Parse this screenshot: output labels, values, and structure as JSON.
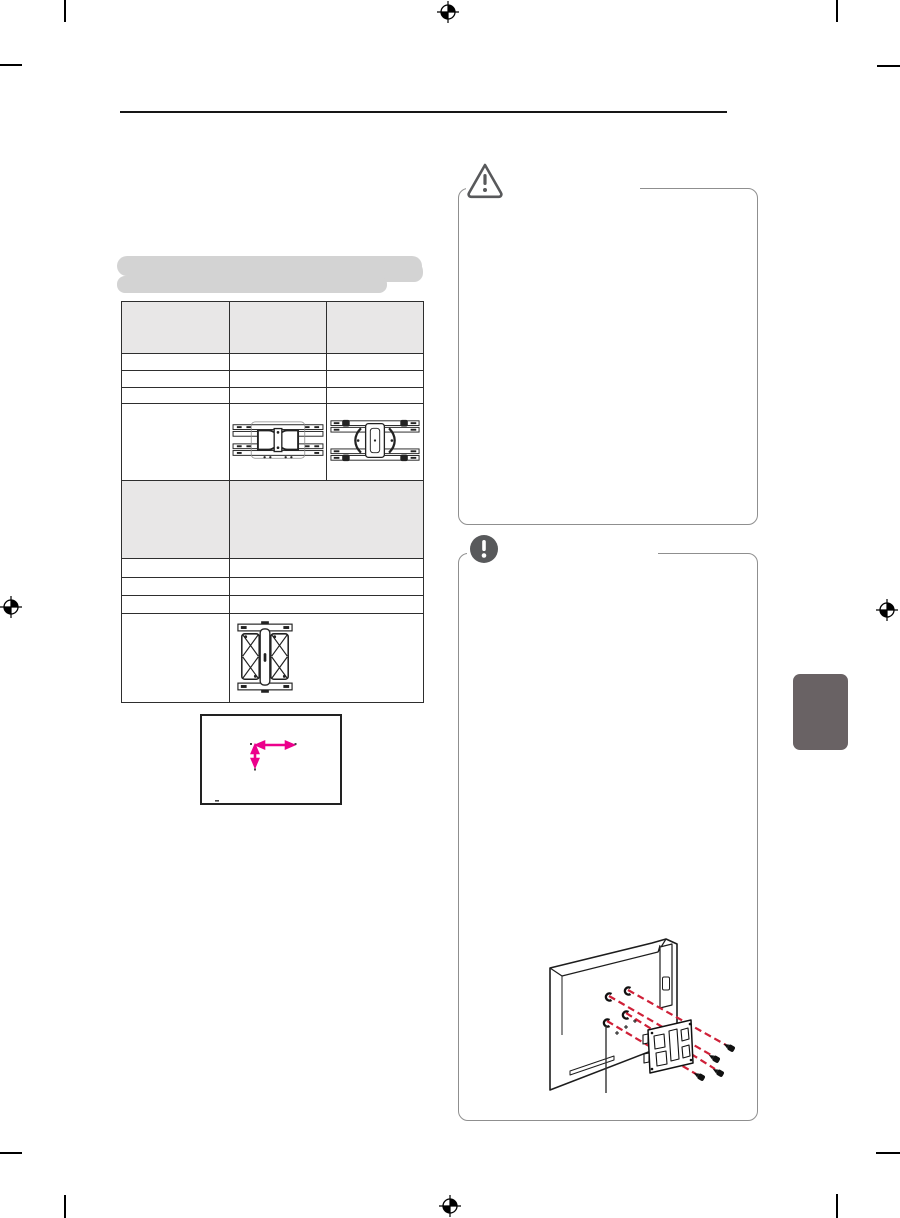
{
  "document": {
    "kind": "scanned-print-manual-page",
    "all_text_blank": true,
    "header_rule": true
  },
  "theme": {
    "page-bg": "#ffffff",
    "rule-color": "#161616",
    "table-border": "#2e2e2e",
    "table-header-bg": "#e8e7e7",
    "redaction-bar": "#d3d3d3",
    "box-border": "#8f8f8f",
    "icon-gray": "#58595b",
    "accent-red": "#cf2038",
    "accent-magenta": "#ec008c",
    "side-tab": "#696264",
    "mark-black": "#000000",
    "line-art": "#222222"
  },
  "heading": {
    "line1": "",
    "line2": "",
    "redacted": true
  },
  "table": {
    "header": [
      "",
      "",
      ""
    ],
    "rows_top": [
      [
        "",
        "",
        ""
      ],
      [
        "",
        "",
        ""
      ],
      [
        "",
        "",
        ""
      ]
    ],
    "image_row": {
      "col1": "",
      "col2_figure": "wall-mount-bracket-side-a",
      "col3_figure": "wall-mount-bracket-side-b"
    },
    "gray_row": [
      "",
      ""
    ],
    "rows_bottom": [
      [
        "",
        ""
      ],
      [
        "",
        ""
      ],
      [
        "",
        ""
      ]
    ],
    "image_row2": {
      "col1": "",
      "figure": "wall-mount-bracket-front"
    }
  },
  "caution_box": {
    "title": "",
    "body": "",
    "icon": "warning-triangle-icon"
  },
  "note_box": {
    "title": "",
    "body": "",
    "icon": "exclamation-circle-icon",
    "figure": "tv-rear-wall-bracket-screws-illustration"
  },
  "dimension_figure": {
    "arrows": [
      "horizontal",
      "vertical"
    ],
    "arrow_color": "#ec008c"
  },
  "print_marks": {
    "registration_marks": 4,
    "corner_ticks": 8
  },
  "icons": {
    "warning": "warning-triangle-icon",
    "note": "exclamation-circle-icon",
    "registration": "registration-mark-icon"
  }
}
